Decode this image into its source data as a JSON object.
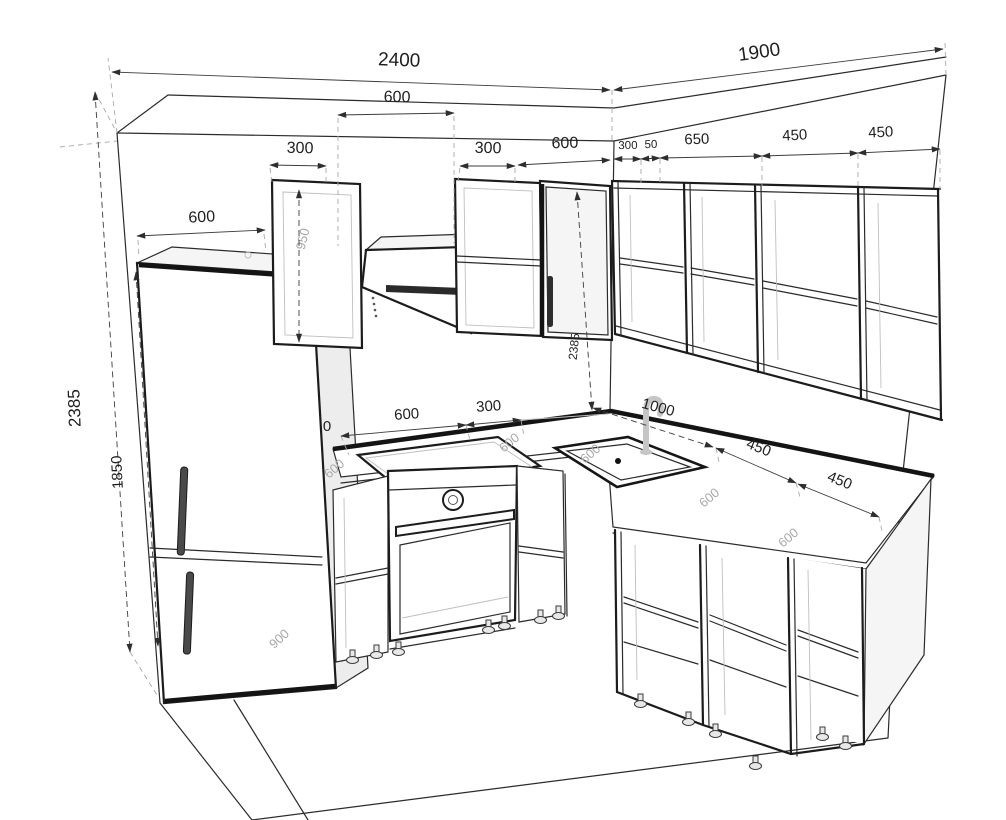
{
  "dimensions": {
    "left_wall_total": "2400",
    "right_wall_total": "1900",
    "hood_width": "600",
    "upper_left_row": [
      "300",
      "300",
      "600"
    ],
    "upper_right_row": [
      "300",
      "50",
      "650",
      "450",
      "450"
    ],
    "tall_cabinet_depth": "600",
    "wall_height_left": "2385",
    "fridge_height": "1850",
    "wall_cabinet_height": "950",
    "wall_height_corner": "2385",
    "worktop_left_row": [
      "0",
      "600",
      "300"
    ],
    "worktop_right_first": "1000",
    "worktop_right_row": [
      "450",
      "450"
    ],
    "worktop_depth_labels": [
      "600",
      "600",
      "600",
      "600",
      "600"
    ],
    "fridge_lower_section_height": "900"
  },
  "colors": {
    "line": "#2b2b2b",
    "dimension": "#3c3c3c",
    "light_line": "#bfbfbf",
    "surface_label": "#a8a8a8",
    "background": "#ffffff"
  }
}
